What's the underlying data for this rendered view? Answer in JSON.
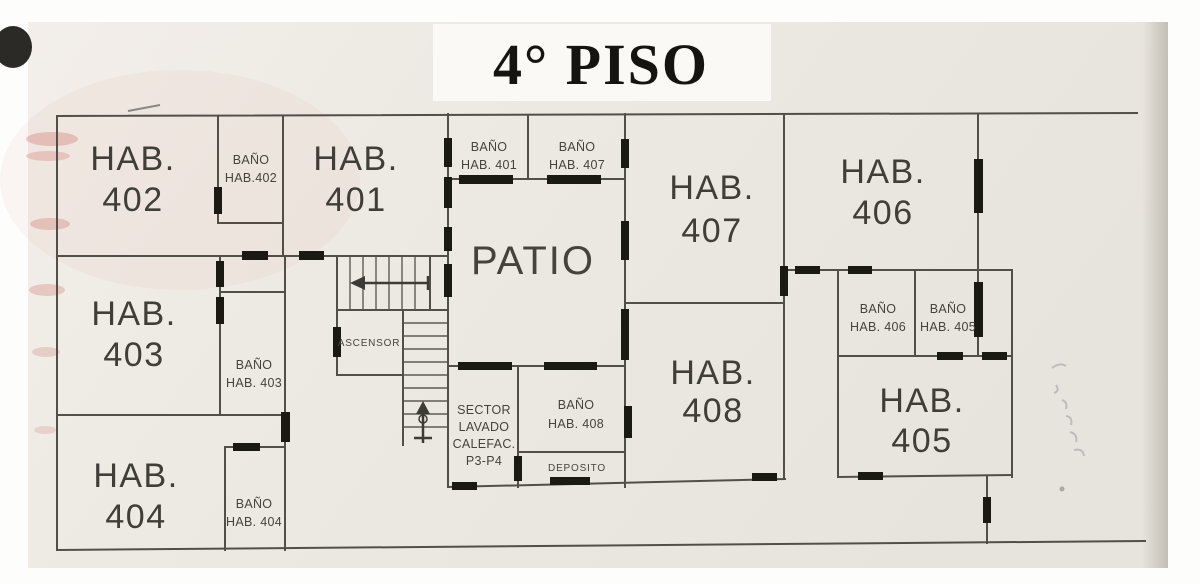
{
  "title": "4° PISO",
  "rooms": {
    "hab401": {
      "name": "HAB.",
      "number": "401"
    },
    "hab402": {
      "name": "HAB.",
      "number": "402"
    },
    "hab403": {
      "name": "HAB.",
      "number": "403"
    },
    "hab404": {
      "name": "HAB.",
      "number": "404"
    },
    "hab405": {
      "name": "HAB.",
      "number": "405"
    },
    "hab406": {
      "name": "HAB.",
      "number": "406"
    },
    "hab407": {
      "name": "HAB.",
      "number": "407"
    },
    "hab408": {
      "name": "HAB.",
      "number": "408"
    },
    "bano401": {
      "l1": "BAÑO",
      "l2": "HAB. 401"
    },
    "bano402": {
      "l1": "BAÑO",
      "l2": "HAB.402"
    },
    "bano403": {
      "l1": "BAÑO",
      "l2": "HAB. 403"
    },
    "bano404": {
      "l1": "BAÑO",
      "l2": "HAB. 404"
    },
    "bano405": {
      "l1": "BAÑO",
      "l2": "HAB. 405"
    },
    "bano406": {
      "l1": "BAÑO",
      "l2": "HAB. 406"
    },
    "bano407": {
      "l1": "BAÑO",
      "l2": "HAB. 407"
    },
    "bano408": {
      "l1": "BAÑO",
      "l2": "HAB. 408"
    },
    "patio": {
      "label": "PATIO"
    },
    "ascensor": {
      "label": "ASCENSOR"
    },
    "deposito": {
      "label": "DEPOSITO"
    },
    "sector_lavado": {
      "l1": "SECTOR",
      "l2": "LAVADO",
      "l3": "CALEFAC.",
      "l4": "P3-P4"
    }
  },
  "colors": {
    "wall": "#514f48",
    "door_marker": "#1a1912",
    "paper": "#ebe8e1",
    "label_text": "#403e38",
    "title_text": "#151410"
  }
}
